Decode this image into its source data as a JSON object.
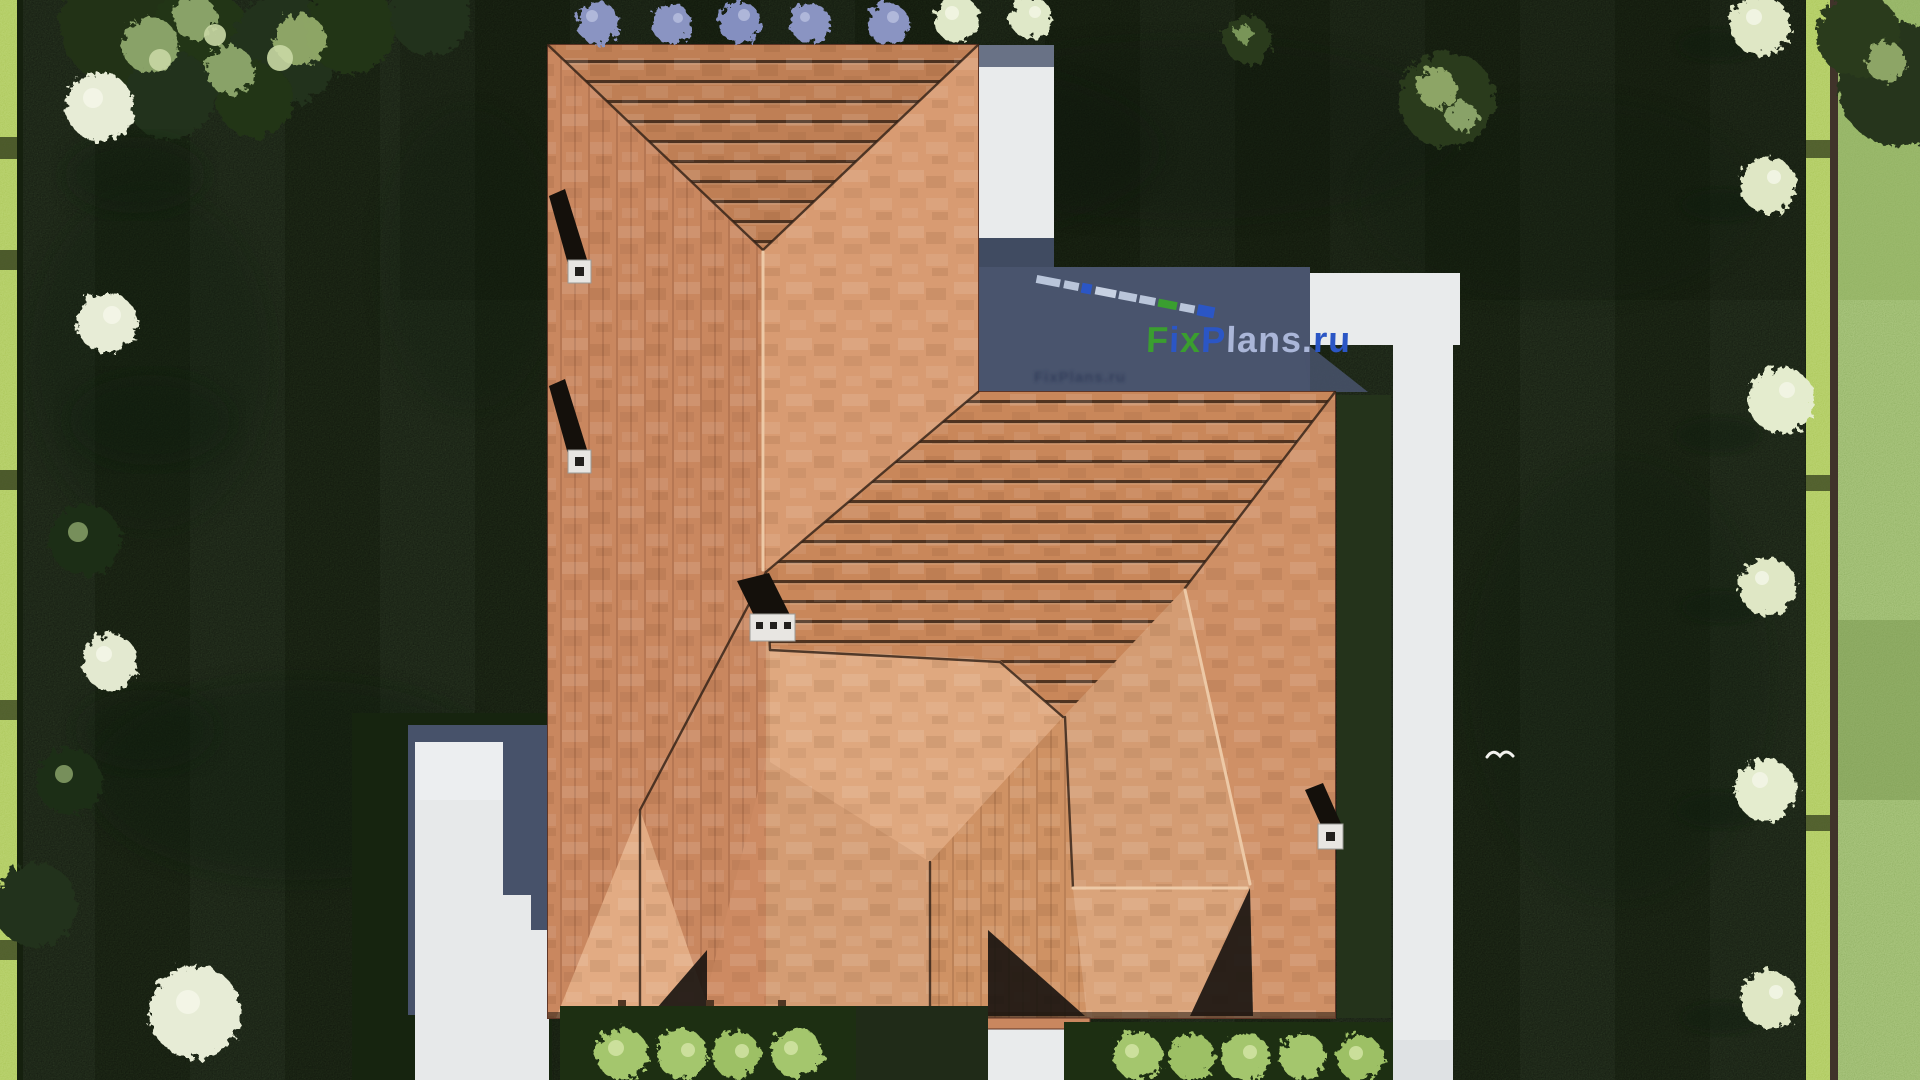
{
  "watermark": {
    "full": "FixPlans.ru",
    "seg_f": "F",
    "seg_i": "i",
    "seg_x": "x",
    "seg_p": "P",
    "seg_lans": "lans.",
    "seg_ru": "ru",
    "color_green": "#3a9e2f",
    "color_blue": "#2b56c5",
    "color_light": "#aab6d8"
  },
  "scene": {
    "colors": {
      "roof_main": "#c9875f",
      "roof_light": "#dda87f",
      "roof_stripe_dark": "#46301f",
      "lawn_dark": "#2b3b21",
      "outer_grass": "#82a455",
      "hedge_bright": "#a3bf4b",
      "path_white": "#e9ebec",
      "shadow_slate": "#49546d",
      "bush_purple": "#8a94c2",
      "tree_white": "#e7ecd6"
    }
  }
}
